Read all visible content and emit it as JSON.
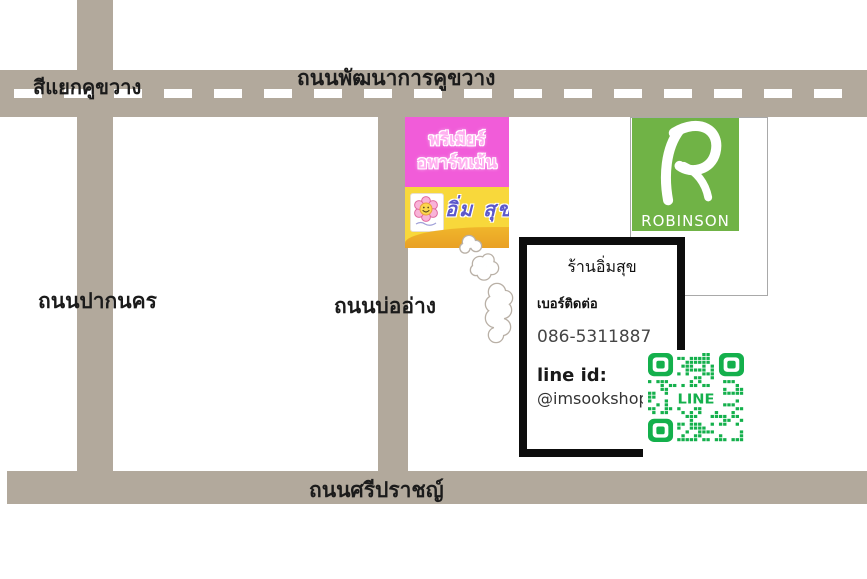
{
  "map": {
    "labels": {
      "intersection": "สีแยกคูขวาง",
      "road_top": "ถนนพัฒนาการคูขวาง",
      "road_left": "ถนนปากนคร",
      "road_mid": "ถนนบ่ออ่าง",
      "road_bottom": "ถนนศรีปราชญ์"
    }
  },
  "premier_sign": {
    "line1": "พรีเมียร์",
    "line2": "อพาร์ทเม้น",
    "brand": "อิ่ม สุข"
  },
  "robinson": {
    "name": "ROBINSON"
  },
  "contact_card": {
    "title": "ร้านอิ่มสุข",
    "contact_label": "เบอร์ติดต่อ",
    "phone": "086-5311887",
    "line_id_label": "line id:",
    "line_id": "@imsookshop"
  },
  "qr": {
    "label": "LINE"
  },
  "colors": {
    "road": "#b2a99c",
    "pink": "#f15cd9",
    "pink_text": "#ffaff0",
    "yellow": "#f8d83b",
    "orange": "#e9a125",
    "blue_text": "#5c58cb",
    "green": "#70b346",
    "qr_green": "#14b04c"
  }
}
